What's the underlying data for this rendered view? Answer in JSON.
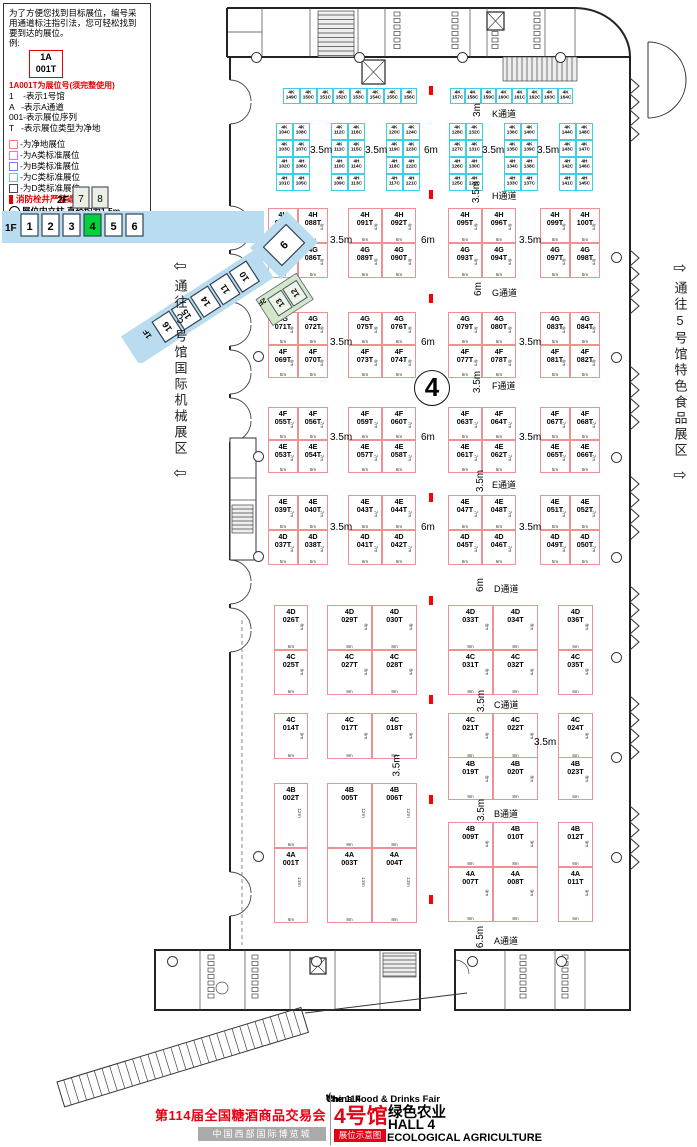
{
  "legend": {
    "intro_lines": [
      "为了方便您找到目标展位，编号采",
      "用通道标注指引法，您可轻松找到",
      "要到达的展位。",
      "例:"
    ],
    "example_booth": [
      "1A",
      "001T"
    ],
    "example_note": "1A001T为展位号(须完整使用)",
    "code_lines": [
      "1    -表示1号馆",
      "A   -表示A通道",
      "001-表示展位序列",
      "T   -表示展位类型为净地"
    ],
    "booth_types": [
      {
        "color": "#f87c7c",
        "label": "-为净地展位"
      },
      {
        "color": "#f06df0",
        "label": "-为A类标准展位"
      },
      {
        "color": "#7b7bf8",
        "label": "-为B类标准展位"
      },
      {
        "color": "#49d7e8",
        "label": "-为C类标准展位"
      },
      {
        "color": "#4a4a4a",
        "label": "-为D类标准展位"
      }
    ],
    "fire_note": "消防栓井严禁遮挡",
    "pillar_note": "展位内立柱 直径均为1.5m"
  },
  "minimap": {
    "f2_label": "2F",
    "f1_label": "1F",
    "f2_halls": [
      "7",
      "8"
    ],
    "f1_halls": [
      "1",
      "2",
      "3",
      "4",
      "5",
      "6"
    ],
    "current_hall": "4",
    "hall_9": "9",
    "diag_halls": [
      "10",
      "11",
      "14",
      "15",
      "16"
    ],
    "diag_floor_label": "1F",
    "annex_halls": [
      "12",
      "13"
    ],
    "annex_floor_label": "2F",
    "highlight_color": "#00d23c"
  },
  "side_labels": {
    "left": "通往3号馆国际机械展区",
    "right": "通往5号馆特色食品展区",
    "left_arrow": "⇦",
    "right_arrow": "⇨"
  },
  "hall_number": "4",
  "aisles": [
    {
      "name": "K通道",
      "dim": "3m"
    },
    {
      "name": "H通道",
      "dim": "3.5m"
    },
    {
      "name": "G通道",
      "dim": "6m"
    },
    {
      "name": "F通道",
      "dim": "3.5m"
    },
    {
      "name": "E通道",
      "dim": "3.5m"
    },
    {
      "name": "D通道",
      "dim": "6m"
    },
    {
      "name": "C通道",
      "dim": "3.5m"
    },
    {
      "name": "B通道",
      "dim": "3.5m"
    },
    {
      "name": "A通道",
      "dim": "6.5m"
    }
  ],
  "k_section": {
    "top_rows": [
      [
        "4K 149C",
        "4K 150C",
        "4K 151C",
        "4K 152C",
        "4K 153C",
        "4K 154C",
        "4K 155C",
        "4K 156C"
      ],
      [
        "4K 157C",
        "4K 158C",
        "4K 159C",
        "4K 160C",
        "4K 161C",
        "4K 162C",
        "4K 163C",
        "4K 164C"
      ]
    ],
    "groups": [
      [
        [
          "4K 104C",
          "4K 108C"
        ],
        [
          "4K 103C",
          "4K 107C"
        ],
        [
          "4H 102C",
          "4H 106C"
        ],
        [
          "4H 101C",
          "4H 105C"
        ]
      ],
      [
        [
          "4K 112C",
          "4K 116C"
        ],
        [
          "4K 111C",
          "4K 115C"
        ],
        [
          "4H 110C",
          "4H 114C"
        ],
        [
          "4H 109C",
          "4H 113C"
        ]
      ],
      [
        [
          "4K 120C",
          "4K 124C"
        ],
        [
          "4K 119C",
          "4K 123C"
        ],
        [
          "4H 118C",
          "4H 122C"
        ],
        [
          "4H 117C",
          "4H 121C"
        ]
      ],
      [
        [
          "4K 128C",
          "4K 132C"
        ],
        [
          "4K 127C",
          "4K 131C"
        ],
        [
          "4H 126C",
          "4H 130C"
        ],
        [
          "4H 125C",
          "4H 129C"
        ]
      ],
      [
        [
          "4K 136C",
          "4K 140C"
        ],
        [
          "4K 135C",
          "4K 139C"
        ],
        [
          "4H 134C",
          "4H 138C"
        ],
        [
          "4H 133C",
          "4H 137C"
        ]
      ],
      [
        [
          "4K 144C",
          "4K 148C"
        ],
        [
          "4K 143C",
          "4K 147C"
        ],
        [
          "4H 142C",
          "4H 146C"
        ],
        [
          "4H 141C",
          "4H 145C"
        ]
      ]
    ]
  },
  "k_gap_labels": [
    "3.5m",
    "3.5m",
    "6m",
    "3.5m",
    "3.5m"
  ],
  "red_upper": [
    {
      "rows": [
        {
          "booths": [
            "4H 087T",
            "4H 088T",
            "4H 091T",
            "4H 092T",
            "4H 095T",
            "4H 096T",
            "4H 099T",
            "4H 100T"
          ],
          "widths": [
            "5m",
            "5m",
            "6m",
            "6m",
            "6m",
            "6m",
            "5m",
            "5m"
          ],
          "depth": "6m"
        },
        {
          "booths": [
            "4G 085T",
            "4G 086T",
            "4G 089T",
            "4G 090T",
            "4G 093T",
            "4G 094T",
            "4G 097T",
            "4G 098T"
          ],
          "widths": [
            "5m",
            "5m",
            "6m",
            "6m",
            "6m",
            "6m",
            "5m",
            "5m"
          ],
          "depth": "6m"
        }
      ],
      "gaps": [
        "3.5m",
        "6m",
        "3.5m"
      ]
    },
    {
      "rows": [
        {
          "booths": [
            "4G 071T",
            "4G 072T",
            "4G 075T",
            "4G 076T",
            "4G 079T",
            "4G 080T",
            "4G 083T",
            "4G 084T"
          ],
          "widths": [
            "5m",
            "5m",
            "6m",
            "6m",
            "6m",
            "6m",
            "5m",
            "5m"
          ],
          "depth": "6m"
        },
        {
          "booths": [
            "4F 069T",
            "4F 070T",
            "4F 073T",
            "4F 074T",
            "4F 077T",
            "4F 078T",
            "4F 081T",
            "4F 082T"
          ],
          "widths": [
            "5m",
            "5m",
            "6m",
            "6m",
            "6m",
            "6m",
            "5m",
            "5m"
          ],
          "depth": "6m"
        }
      ],
      "gaps": [
        "3.5m",
        "6m",
        "3.5m"
      ]
    },
    {
      "rows": [
        {
          "booths": [
            "4F 055T",
            "4F 056T",
            "4F 059T",
            "4F 060T",
            "4F 063T",
            "4F 064T",
            "4F 067T",
            "4F 068T"
          ],
          "widths": [
            "5m",
            "5m",
            "6m",
            "6m",
            "6m",
            "6m",
            "5m",
            "5m"
          ],
          "depth": "7m"
        },
        {
          "booths": [
            "4E 053T",
            "4E 054T",
            "4E 057T",
            "4E 058T",
            "4E 061T",
            "4E 062T",
            "4E 065T",
            "4E 066T"
          ],
          "widths": [
            "5m",
            "5m",
            "6m",
            "6m",
            "6m",
            "6m",
            "5m",
            "5m"
          ],
          "depth": "7m"
        }
      ],
      "gaps": [
        "3.5m",
        "6m",
        "3.5m"
      ]
    },
    {
      "rows": [
        {
          "booths": [
            "4E 039T",
            "4E 040T",
            "4E 043T",
            "4E 044T",
            "4E 047T",
            "4E 048T",
            "4E 051T",
            "4E 052T"
          ],
          "widths": [
            "5m",
            "5m",
            "6m",
            "6m",
            "6m",
            "6m",
            "5m",
            "5m"
          ],
          "depth": "7m"
        },
        {
          "booths": [
            "4D 037T",
            "4D 038T",
            "4D 041T",
            "4D 042T",
            "4D 045T",
            "4D 046T",
            "4D 049T",
            "4D 050T"
          ],
          "widths": [
            "5m",
            "5m",
            "6m",
            "6m",
            "6m",
            "6m",
            "5m",
            "5m"
          ],
          "depth": "7m"
        }
      ],
      "gaps": [
        "3.5m",
        "6m",
        "3.5m"
      ]
    }
  ],
  "red_lower": [
    {
      "rows": [
        {
          "booths": [
            "4D 026T",
            "4D 029T",
            "4D 030T",
            "4D 033T",
            "4D 034T",
            "4D 036T"
          ],
          "widths": [
            "6m",
            "8m",
            "8m",
            "8m",
            "8m",
            "6m"
          ],
          "depth": "8m"
        },
        {
          "booths": [
            "4C 025T",
            "4C 027T",
            "4C 028T",
            "4C 031T",
            "4C 032T",
            "4C 035T"
          ],
          "widths": [
            "6m",
            "8m",
            "8m",
            "8m",
            "8m",
            "6m"
          ],
          "depth": "8m"
        }
      ]
    },
    {
      "rows": [
        {
          "booths": [
            "4C 014T",
            "4C 017T",
            "4C 018T",
            "4C 021T",
            "4C 022T",
            "4C 024T"
          ],
          "widths": [
            "6m",
            "8m",
            "8m",
            "8m",
            "8m",
            "6m"
          ],
          "depth": "9m"
        }
      ]
    },
    {
      "rows": [
        {
          "booths": [
            "4B 019T",
            "4B 020T",
            "4B 023T"
          ],
          "widths": [
            "8m",
            "8m",
            "6m"
          ],
          "depth": "8m"
        }
      ]
    },
    {
      "rows": [
        {
          "booths": [
            "4B 002T",
            "4B 005T",
            "4B 006T"
          ],
          "widths": [
            "6m",
            "8m",
            "8m"
          ],
          "depth": "12m"
        }
      ]
    },
    {
      "rows": [
        {
          "booths": [
            "4A 001T",
            "4A 003T",
            "4A 004T"
          ],
          "widths": [
            "6m",
            "8m",
            "8m"
          ],
          "depth": "13m"
        }
      ]
    },
    {
      "rows": [
        {
          "booths": [
            "4B 009T",
            "4B 010T",
            "4B 012T"
          ],
          "widths": [
            "8m",
            "8m",
            "6m"
          ],
          "depth": "9m"
        }
      ]
    },
    {
      "rows": [
        {
          "booths": [
            "4A 007T",
            "4A 008T",
            "4A 011T"
          ],
          "widths": [
            "8m",
            "8m",
            "6m"
          ],
          "depth": "9m"
        }
      ]
    }
  ],
  "misc_labels": [
    "3.5m",
    "3.5m"
  ],
  "title_block": {
    "en_pre": "The 114",
    "en_sup": "th",
    "en_post": " China Food & Drinks Fair",
    "cn_title": "第114届全国糖酒商品交易会",
    "venue": "中国西部国际博览城",
    "hall_cn": "4号馆",
    "theme_cn": "绿色农业",
    "hall_en": "HALL 4",
    "badge": "展位示意图",
    "theme_en": "ECOLOGICAL AGRICULTURE"
  }
}
